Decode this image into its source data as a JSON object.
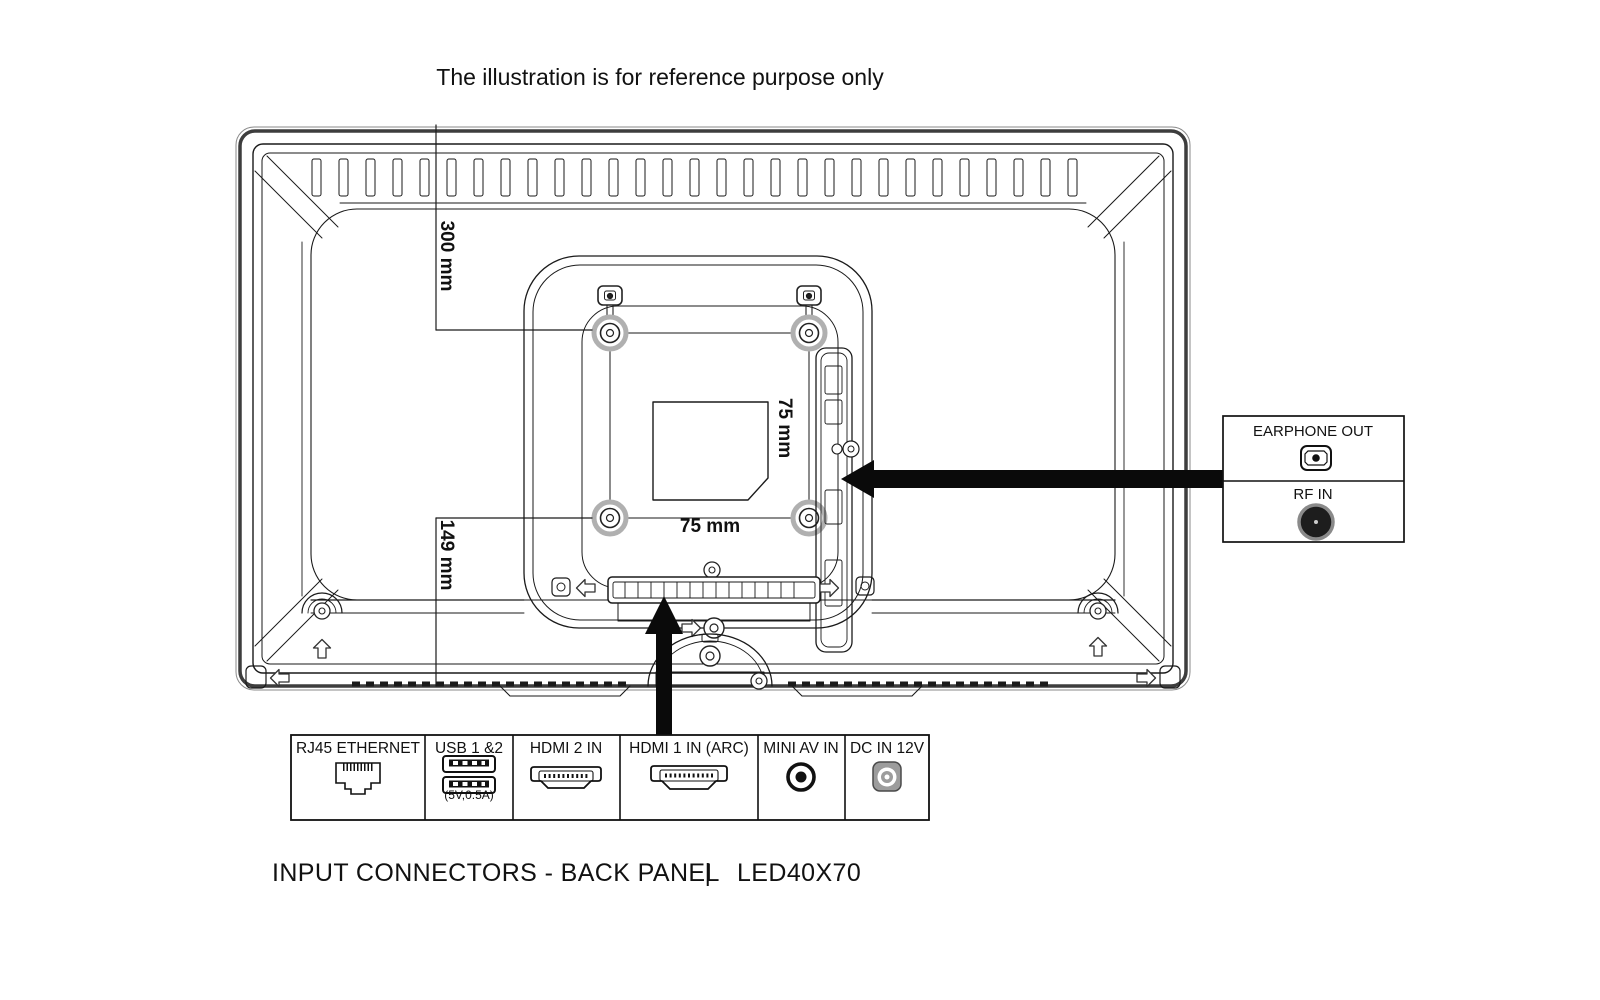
{
  "caption": "The illustration is for reference purpose only",
  "footer": {
    "heading": "INPUT CONNECTORS - BACK PANEL",
    "separator": "|",
    "model": "LED40X70"
  },
  "dimensions": {
    "top_offset": "300 mm",
    "bottom_offset": "149 mm",
    "vesa_width": "75 mm",
    "vesa_height": "75 mm"
  },
  "side_outputs": {
    "earphone": {
      "label": "EARPHONE OUT",
      "icon": "earphone-jack-icon"
    },
    "rf": {
      "label": "RF IN",
      "icon": "rf-coax-icon"
    }
  },
  "connector_table": {
    "cells": [
      {
        "label": "RJ45 ETHERNET",
        "icon": "rj45-ethernet-icon"
      },
      {
        "label": "USB 1 &2",
        "sub": "(5V,0.5A)",
        "icon": "usb-ports-icon"
      },
      {
        "label": "HDMI 2 IN",
        "icon": "hdmi-port-icon"
      },
      {
        "label": "HDMI 1 IN (ARC)",
        "icon": "hdmi-port-icon"
      },
      {
        "label": "MINI AV IN",
        "icon": "mini-av-jack-icon"
      },
      {
        "label": "DC IN 12V",
        "icon": "dc-in-jack-icon"
      }
    ]
  },
  "colors": {
    "line": "#1a1a1a",
    "frame": "#3d3d3d",
    "screw_ring": "#b0b0b0",
    "arrow": "#0a0a0a",
    "background": "#ffffff"
  }
}
